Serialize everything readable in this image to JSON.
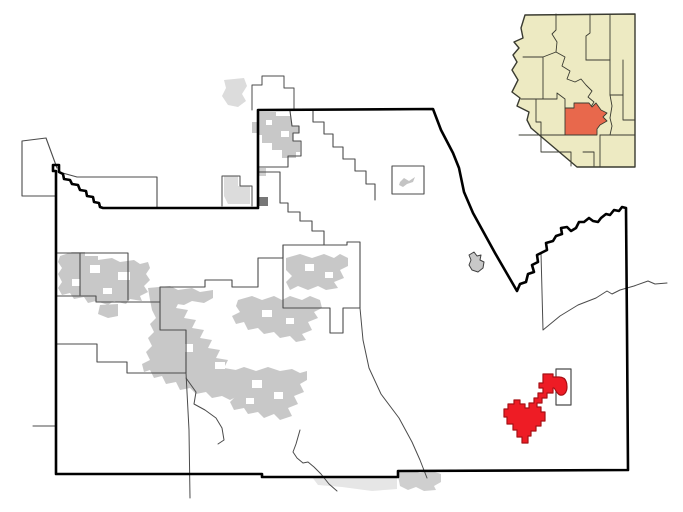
{
  "canvas": {
    "width": 683,
    "height": 512,
    "background": "#ffffff"
  },
  "colors": {
    "urban_gray": "#c8c8c8",
    "faded_gray": "#dcdcdc",
    "boundary_thin": "#4b4b4b",
    "county_border": "#000000",
    "highlight_red": "#ee1c25",
    "highlight_red_edge": "#a81015",
    "inset_land": "#edeac2",
    "inset_line": "#3a3b31",
    "inset_highlight": "#e8684c"
  },
  "maps": [
    {
      "group": "main-map",
      "layers": [
        {
          "name": "exterior-faded-area-nw",
          "d": "M224,176 L238,176 L238,186 L250,186 L250,204 L228,204 L224,196 Z",
          "fill": "#dcdcdc"
        },
        {
          "name": "exterior-faded-area-north",
          "d": "M224,80 L244,78 L247,86 L242,94 L246,101 L238,107 L228,105 L222,96 L226,88 Z",
          "fill": "#dcdcdc"
        },
        {
          "name": "exterior-faded-band-south",
          "d": "M312,477 L397,476 L397,489 L372,491 L342,487 L318,485 Z",
          "fill": "#dcdcdc",
          "opacity": 0.7
        },
        {
          "name": "urban-area-border-strip",
          "d": "M397,471 L412,470 L420,473 L432,471 L441,474 L441,482 L434,486 L436,490 L424,491 L416,487 L408,490 L400,486 Z",
          "fill": "#cfcfcf"
        },
        {
          "name": "boundary-nw-protrusion",
          "d": "M46,138 L22,141 L22,196 L56,196 M46,138 L57,168 M59,172 L77,177 L157,177 L157,208",
          "stroke": "#4b4b4b",
          "sw": 1.1
        },
        {
          "name": "boundary-west-poke",
          "d": "M33,426 L56,426",
          "stroke": "#4b4b4b",
          "sw": 1.1
        },
        {
          "name": "boundary-exterior-nw",
          "d": "M222,206 L222,176 L240,176 L240,186 L252,186 L252,206",
          "stroke": "#4b4b4b",
          "sw": 1
        },
        {
          "name": "boundary-exterior-north",
          "d": "M252,110 L252,85 L262,85 L262,76 L284,76 L284,88 L294,88 L294,110",
          "stroke": "#4b4b4b",
          "sw": 1
        },
        {
          "name": "urban-area-north-town",
          "d": "M259,112 L276,112 L276,116 L290,116 L292,126 L299,126 L299,133 L293,133 L293,141 L300,141 L300,152 L296,152 L296,158 L282,158 L282,150 L272,150 L272,143 L262,143 L262,135 L259,135 Z",
          "fill": "#c8c8c8"
        },
        {
          "name": "urban-area-north-notch",
          "d": "M252,122 L258,122 L258,133 L252,133 Z",
          "fill": "#c8c8c8"
        },
        {
          "name": "urban-speckles-north",
          "d": "M266,120 h6 v5 h-6 Z M281,131 h8 v6 h-8 Z",
          "fill": "#ffffff"
        },
        {
          "name": "urban-area-dark-square",
          "d": "M259,197 h9 v9 h-9 Z",
          "fill": "#777777"
        },
        {
          "name": "urban-area-small-bit",
          "d": "M259,168 h7 v8 h-7 Z",
          "fill": "#cfcfcf"
        },
        {
          "name": "urban-area-northwest-cluster",
          "d": "M60,256 L72,252 L85,252 L85,256 L98,256 L98,260 L112,258 L120,262 L134,260 L140,264 L148,262 L150,268 L146,274 L150,280 L144,286 L148,292 L140,296 L142,301 L130,299 L126,304 L114,301 L108,305 L96,301 L88,303 L84,297 L74,299 L70,293 L62,295 L58,288 L62,282 L58,274 L62,268 L58,262 Z",
          "fill": "#c8c8c8"
        },
        {
          "name": "urban-area-nw-extension",
          "d": "M148,288 L170,286 L178,290 L192,288 L200,292 L213,290 L213,298 L204,303 L192,301 L184,305 L170,303 L160,305 L150,300 Z",
          "fill": "#c8c8c8"
        },
        {
          "name": "urban-speckles-nw",
          "d": "M90,265 h10 v8 h-10 Z M118,272 h12 v8 h-12 Z M72,279 h8 v7 h-8 Z M103,288 h9 v6 h-9 Z",
          "fill": "#ffffff"
        },
        {
          "name": "urban-area-small-south-bit",
          "d": "M100,305 L118,304 L118,316 L108,318 L98,314 Z",
          "fill": "#c8c8c8"
        },
        {
          "name": "urban-area-central-cluster",
          "d": "M150,300 L168,296 L180,300 L176,308 L188,310 L184,318 L196,320 L192,328 L204,330 L200,338 L212,340 L208,348 L220,350 L216,358 L228,360 L224,368 L236,370 L232,378 L244,380 L240,388 L252,388 L256,394 L248,398 L238,396 L230,400 L222,396 L212,398 L206,392 L196,394 L190,388 L180,390 L176,382 L166,384 L162,376 L154,378 L150,370 L144,372 L142,364 L150,360 L146,352 L152,346 L148,338 L154,332 L150,324 L156,318 L152,310 Z",
          "fill": "#c8c8c8"
        },
        {
          "name": "urban-area-east-cluster",
          "d": "M238,300 L252,296 L262,300 L274,296 L282,300 L290,296 L302,300 L310,296 L320,300 L322,308 L314,312 L318,318 L308,322 L312,330 L302,334 L306,340 L296,342 L290,336 L280,338 L274,332 L264,334 L258,328 L248,330 L244,322 L236,324 L232,316 L240,312 L236,306 Z",
          "fill": "#c8c8c8"
        },
        {
          "name": "urban-speckles-central",
          "d": "M200,320 h10 v8 h-10 Z M228,336 h9 v7 h-9 Z M185,344 h8 v8 h-8 Z M262,310 h10 v7 h-10 Z M286,318 h8 v6 h-8 Z M215,362 h10 v7 h-10 Z",
          "fill": "#ffffff"
        },
        {
          "name": "urban-area-box-blob",
          "d": "M286,258 L300,254 L312,258 L324,254 L334,258 L340,254 L348,258 L348,266 L340,270 L344,278 L334,282 L338,288 L326,290 L318,286 L308,290 L298,286 L290,290 L286,282 L292,276 L286,270 Z",
          "fill": "#c8c8c8"
        },
        {
          "name": "urban-speckles-box",
          "d": "M305,264 h9 v7 h-9 Z M325,272 h8 v6 h-8 Z",
          "fill": "#ffffff"
        },
        {
          "name": "urban-area-south-cluster",
          "d": "M230,372 L244,367 L256,371 L268,367 L280,371 L292,369 L300,373 L307,371 L307,380 L300,384 L304,392 L294,396 L298,404 L288,408 L292,416 L280,420 L274,414 L264,418 L258,412 L248,414 L244,408 L234,410 L230,402 L236,396 L230,390 L236,384 L228,380 Z",
          "fill": "#c8c8c8"
        },
        {
          "name": "urban-speckles-south",
          "d": "M252,380 h10 v8 h-10 Z M274,392 h9 v7 h-9 Z M246,398 h8 v6 h-8 Z",
          "fill": "#ffffff"
        },
        {
          "name": "boundary-north-town",
          "d": "M290,111 L292,126 L299,126 L299,133 L293,133 L293,141 L301,141 L301,156 L288,156 L288,167 L259,167",
          "stroke": "#4b4b4b",
          "sw": 1.1
        },
        {
          "name": "boundary-north-staircase",
          "d": "M259,172 L280,172 L280,203 L288,203 L288,212 L300,212 L300,221 L312,221 L312,231 L324,231 L324,245",
          "stroke": "#4b4b4b",
          "sw": 1.1
        },
        {
          "name": "boundary-northeast-staircase",
          "d": "M313,110 L313,122 L324,122 L324,134 L333,134 L333,147 L343,147 L343,159 L355,159 L355,171 L366,171 L366,184 L375,184 L375,200",
          "stroke": "#4b4b4b",
          "sw": 1.1
        },
        {
          "name": "boundary-municipal-box",
          "d": "M283,245 L347,245 L347,242 L360,242 L360,308 L343,308 L343,333 L330,333 L330,308 L283,308 Z",
          "stroke": "#4b4b4b",
          "sw": 1.1
        },
        {
          "name": "boundary-central-north",
          "d": "M283,245 L283,258 L258,258 L258,287 L232,287 L232,280 L205,280 L205,287 L160,287 L160,302 L96,302 L96,296 L56,296",
          "stroke": "#4b4b4b",
          "sw": 1.1
        },
        {
          "name": "boundary-west-box",
          "d": "M56,253 L80,253 L80,295 M80,253 L128,253 L128,300",
          "stroke": "#4b4b4b",
          "sw": 1.1
        },
        {
          "name": "boundary-southwest-staircase",
          "d": "M56,344 L97,344 L97,362 L127,362 L127,373 L186,373 M160,302 L160,330 L186,330 L186,373",
          "stroke": "#4b4b4b",
          "sw": 1.1
        },
        {
          "name": "boundary-south-vertical",
          "d": "M186,373 L189,430 L190,498",
          "stroke": "#4b4b4b",
          "sw": 1
        },
        {
          "name": "boundary-south-curve",
          "d": "M186,378 L196,392 L194,404 L205,410 L216,418 L222,428 L224,440 L218,444",
          "stroke": "#4b4b4b",
          "sw": 1
        },
        {
          "name": "boundary-south-wavy",
          "d": "M300,430 L296,444 L293,452 L297,458 L303,463 L308,462 L314,467 L321,474 L329,484 L337,491",
          "stroke": "#4b4b4b",
          "sw": 1
        },
        {
          "name": "boundary-southeast-long",
          "d": "M360,308 L363,340 L369,368 L381,394 L399,418 L412,442 L420,460 L427,478",
          "stroke": "#4b4b4b",
          "sw": 1
        },
        {
          "name": "boundary-east-river",
          "d": "M541,253 L543,330 L560,316 L578,305 L596,298 L607,291 L612,294 L620,290 L634,286 L648,281 L655,284 L667,283",
          "stroke": "#4b4b4b",
          "sw": 1
        },
        {
          "name": "boundary-small-rect-feature",
          "d": "M392,166 h32 v28 h-32 Z",
          "stroke": "#4b4b4b",
          "sw": 1.1,
          "fill": "#ffffff"
        },
        {
          "name": "urban-area-plane-blob",
          "d": "M400,182 L404,178 L409,181 L415,177 L413,182 L407,184 L403,187 L399,185 Z",
          "fill": "#c4c4c4"
        },
        {
          "name": "outlined-blob-east",
          "d": "M469,255 L474,252 L477,256 L481,255 L480,260 L484,262 L483,268 L478,272 L472,270 L469,265 L471,260 Z",
          "fill": "#c8c8c8",
          "stroke": "#3f3f3f",
          "sw": 1
        },
        {
          "name": "county-border",
          "d": "M56,474 L56,171 L53,171 L53,165 L59,165 L59,172 L63,174 L64,179 L70,180 L72,184 L78,185 L80,190 L86,191 L87,196 L93,197 L94,202 L99,203 L100,207 L103,208 L258,208 L258,110 L433,109 L441,130 L453,153 L459,168 L464,192 L473,213 L484,233 L495,253 L506,272 L517,291 L520,284 L526,282 L528,274 L534,272 L532,265 L538,262 L537,255 L543,252 L547,250 L546,243 L553,241 L556,236 L562,234 L561,228 L567,227 L571,231 L576,228 L579,222 L584,222 L589,218 L593,221 L598,222 L601,218 L606,214 L610,215 L614,210 L619,211 L622,207 L626,208 L627,330 L628,470 L398,471 L398,477 L262,477 L262,474 Z",
          "stroke": "#000000",
          "sw": 2.6
        },
        {
          "name": "enclave-rectangle",
          "d": "M556,369 h15 v36 h-15 Z",
          "fill": "#ffffff",
          "stroke": "#4b4b4b",
          "sw": 1.2
        },
        {
          "name": "highlighted-place",
          "d": "M543,374 L553,374 L553,377 L559,377 C565,377 567,381 567,387 C567,392 564,396 560,395 C557,394 556,390 554,388 L553,388 L553,393 L547,393 L547,398 L542,398 L542,403 L537,403 L537,407 L541,407 L541,412 L545,412 L545,421 L541,421 L541,426 L536,426 L536,431 L531,431 L531,436 L528,436 L528,443 L522,443 L522,437 L517,437 L517,430 L513,430 L513,424 L507,424 L507,417 L504,417 L504,409 L508,409 L508,404 L514,404 L514,400 L520,400 L520,404 L525,404 L525,408 L529,408 L529,403 L534,403 L534,398 L538,398 L538,393 L543,393 L543,388 L539,388 L539,383 L543,383 Z",
          "fill": "#ee1c25",
          "stroke": "#a81015",
          "sw": 1.2
        }
      ]
    },
    {
      "group": "inset-map",
      "layers": [
        {
          "name": "inset-state-shape",
          "d": "M525,15 L635,14 L635,167 L577,167 L531,128 L527,120 L529,112 L517,106 L520,98 L512,92 L518,80 L512,70 L517,62 L513,55 L519,48 L514,42 L523,38 L521,28 Z",
          "fill": "#edeac2",
          "stroke": "#3a3b31",
          "sw": 1.4
        },
        {
          "name": "inset-county-line-1",
          "d": "M556,14 L556,30 L552,34 L557,42 L556,52 L543,57 L523,57",
          "stroke": "#3a3b31",
          "sw": 0.9
        },
        {
          "name": "inset-county-line-2",
          "d": "M543,57 L543,99 L521,99",
          "stroke": "#3a3b31",
          "sw": 0.9
        },
        {
          "name": "inset-county-line-3",
          "d": "M519,135 L541,135 L541,122 L536,122 L536,99",
          "stroke": "#3a3b31",
          "sw": 0.9
        },
        {
          "name": "inset-county-line-4",
          "d": "M541,135 L541,152 L571,152 L571,166",
          "stroke": "#3a3b31",
          "sw": 0.9
        },
        {
          "name": "inset-county-line-5",
          "d": "M590,14 L590,33 L586,36 L586,60",
          "stroke": "#3a3b31",
          "sw": 0.9
        },
        {
          "name": "inset-county-line-6",
          "d": "M610,14 L610,95",
          "stroke": "#3a3b31",
          "sw": 0.9
        },
        {
          "name": "inset-county-line-7",
          "d": "M586,60 L610,60",
          "stroke": "#3a3b31",
          "sw": 0.9
        },
        {
          "name": "inset-county-line-8",
          "d": "M556,52 L565,57 L562,66 L570,71 L567,79 L575,82 L581,79 L586,85 L592,91 L588,97 L594,102 L590,108",
          "stroke": "#3a3b31",
          "sw": 0.9
        },
        {
          "name": "inset-county-line-9",
          "d": "M623,60 L623,120 L635,120",
          "stroke": "#3a3b31",
          "sw": 0.9
        },
        {
          "name": "inset-county-line-10",
          "d": "M610,95 L612,106 L610,118 L612,126 L610,135",
          "stroke": "#3a3b31",
          "sw": 0.9
        },
        {
          "name": "inset-county-line-11",
          "d": "M600,135 L635,135",
          "stroke": "#3a3b31",
          "sw": 0.9
        },
        {
          "name": "inset-county-line-12",
          "d": "M600,135 L600,167",
          "stroke": "#3a3b31",
          "sw": 0.9
        },
        {
          "name": "inset-county-line-13",
          "d": "M583,152 L594,152 L594,166",
          "stroke": "#3a3b31",
          "sw": 0.9
        },
        {
          "name": "inset-county-line-14",
          "d": "M543,99 L557,99 L557,93 L565,99 L565,108",
          "stroke": "#3a3b31",
          "sw": 0.9
        },
        {
          "name": "inset-county-line-15",
          "d": "M541,135 L565,135",
          "stroke": "#3a3b31",
          "sw": 0.9
        },
        {
          "name": "inset-county-line-16",
          "d": "M610,95 L623,95",
          "stroke": "#3a3b31",
          "sw": 0.9
        },
        {
          "name": "inset-highlighted-county",
          "d": "M565,108 L574,108 L574,103 L589,103 L592,107 L596,103 L601,110 L607,113 L603,117 L607,121 L600,125 L597,129 L597,135 L565,135 Z",
          "fill": "#e8684c",
          "stroke": "#3a3b31",
          "sw": 0.9
        }
      ]
    }
  ]
}
